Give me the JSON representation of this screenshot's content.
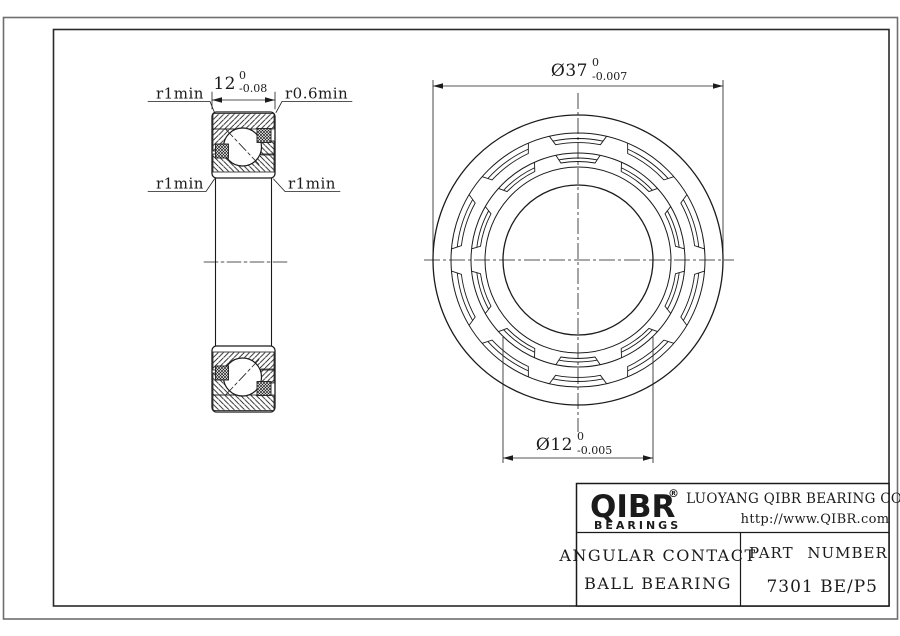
{
  "drawing": {
    "dim_width": {
      "nominal": "12",
      "upper": "0",
      "lower": "-0.08"
    },
    "dim_od": {
      "nominal": "Ø37",
      "upper": "0",
      "lower": "-0.007"
    },
    "dim_bore": {
      "nominal": "Ø12",
      "upper": "0",
      "lower": "-0.005"
    },
    "fillet_top_left": "r1min",
    "fillet_top_right": "r0.6min",
    "fillet_mid_left": "r1min",
    "fillet_mid_right": "r1min"
  },
  "title_block": {
    "logo_text": "QIBR",
    "logo_registered": "®",
    "logo_subtext": "BEARINGS",
    "company": "LUOYANG QIBR BEARING CO., LTD",
    "website": "http://www.QIBR.com",
    "product_line1": "ANGULAR CONTACT",
    "product_line2": "BALL BEARING",
    "part_number_label": "PART NUMBER",
    "part_number": "7301 BE/P5"
  },
  "colors": {
    "line": "#1b1b1b",
    "frame": "#2a2a2a",
    "sheet_border": "#6e6e6e",
    "background": "#ffffff"
  }
}
